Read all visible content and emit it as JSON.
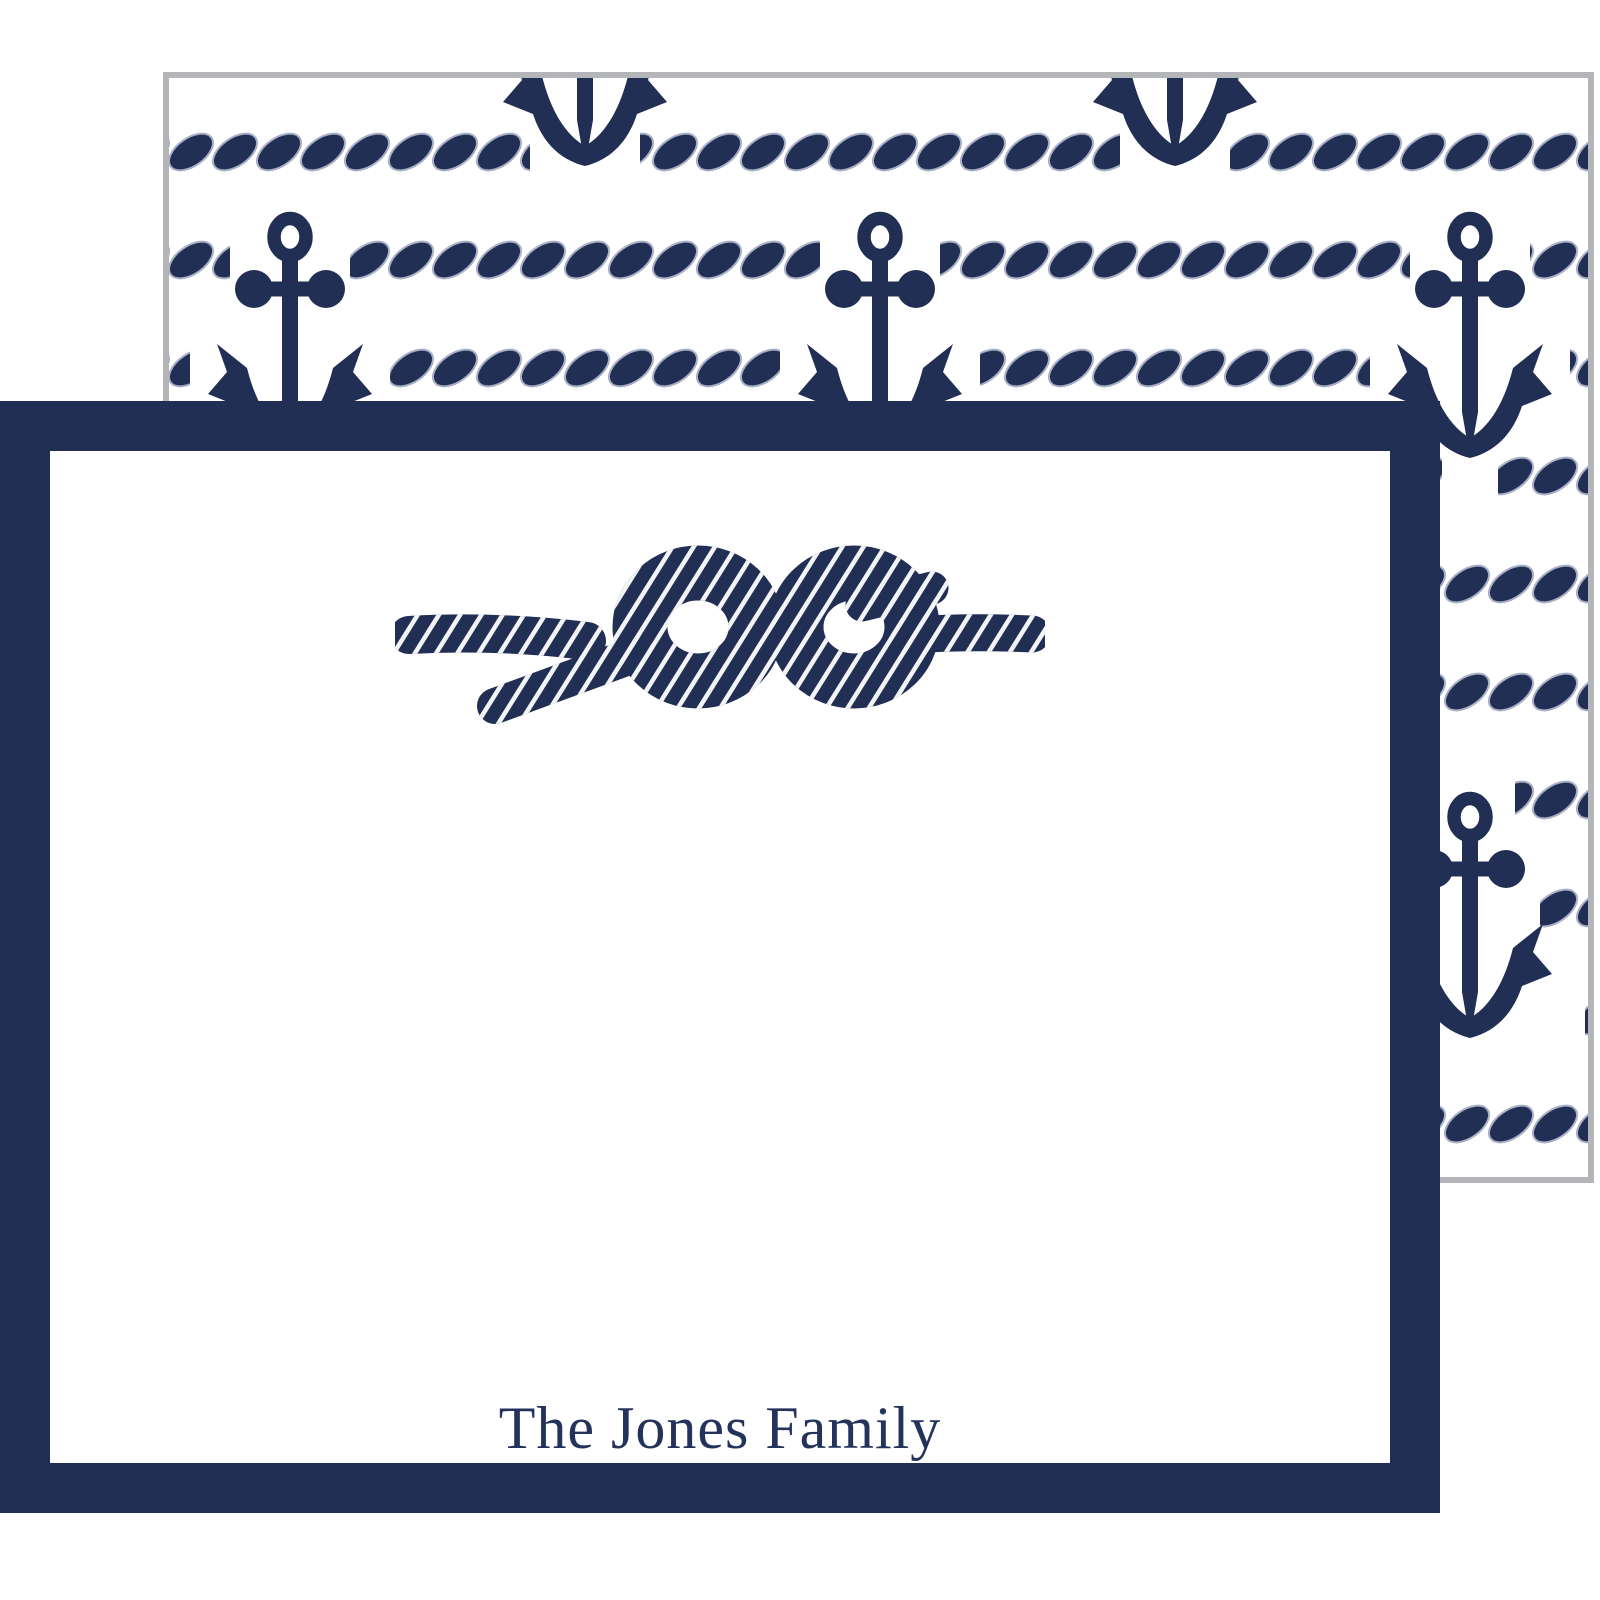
{
  "front_card": {
    "name": "The Jones Family",
    "motif": "square rope knot"
  },
  "back_card": {
    "motif": "rope stripes with anchors"
  },
  "theme": {
    "navy": "#222f55",
    "rope_seam": "#a9b0c6",
    "back_card_border": "#b4b5b8",
    "card_white": "#ffffff",
    "text_navy": "#24335c"
  },
  "pattern": {
    "stripe_height": 40,
    "stripe_tops": [
      54,
      162,
      270,
      378,
      486,
      594,
      702,
      810,
      918,
      1026
    ],
    "stripe_segments": [
      [
        [
          0,
          361
        ],
        [
          471,
          480
        ],
        [
          1061,
          358
        ]
      ],
      [
        [
          0,
          61
        ],
        [
          181,
          470
        ],
        [
          771,
          470
        ],
        [
          1361,
          58
        ]
      ],
      [
        [
          0,
          21
        ],
        [
          221,
          390
        ],
        [
          811,
          390
        ],
        [
          1401,
          18
        ]
      ],
      [
        [
          0,
          93
        ],
        [
          149,
          534
        ],
        [
          739,
          534
        ],
        [
          1329,
          90
        ]
      ],
      [
        [
          0,
          356
        ],
        [
          476,
          470
        ],
        [
          1066,
          353
        ]
      ],
      [
        [
          0,
          301
        ],
        [
          531,
          360
        ],
        [
          1121,
          298
        ]
      ],
      [
        [
          0,
          76
        ],
        [
          166,
          500
        ],
        [
          756,
          500
        ],
        [
          1346,
          73
        ]
      ],
      [
        [
          0,
          51
        ],
        [
          191,
          450
        ],
        [
          781,
          450
        ],
        [
          1371,
          48
        ]
      ],
      [
        [
          0,
          6
        ],
        [
          236,
          360
        ],
        [
          826,
          360
        ],
        [
          1416,
          3
        ]
      ],
      [
        [
          0,
          371
        ],
        [
          461,
          500
        ],
        [
          1051,
          368
        ]
      ]
    ],
    "anchors": [
      [
        416,
        -160
      ],
      [
        1006,
        -160
      ],
      [
        121,
        132
      ],
      [
        711,
        132
      ],
      [
        1301,
        132
      ],
      [
        416,
        420
      ],
      [
        1006,
        420
      ],
      [
        121,
        712
      ],
      [
        711,
        712
      ],
      [
        1301,
        712
      ],
      [
        416,
        1000
      ],
      [
        1006,
        1000
      ]
    ]
  }
}
